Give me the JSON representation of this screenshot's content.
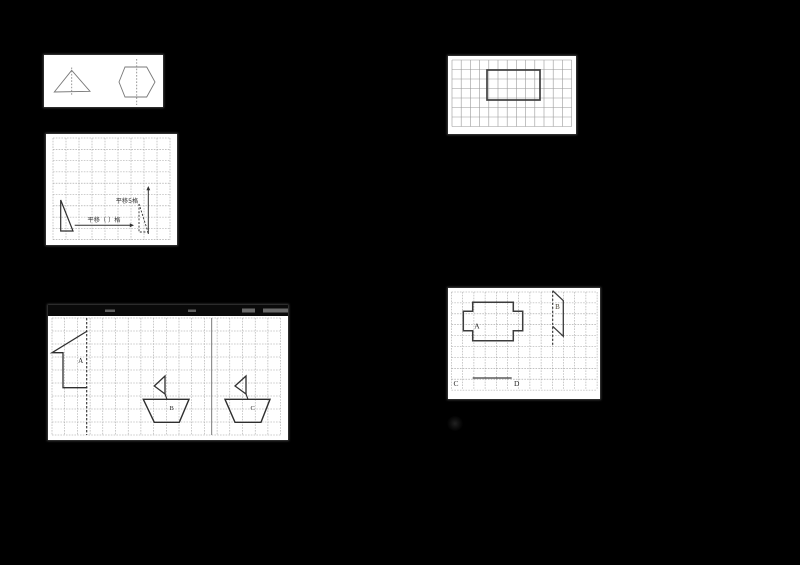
{
  "page": {
    "background": "#000000",
    "width": 800,
    "height": 565,
    "description": "Scanned elementary math worksheet figures (symmetry and translation) on black background"
  },
  "colors": {
    "panel_bg": "#ffffff",
    "grid_line": "#9e9e9e",
    "light_shape": "#787878",
    "bold_shape": "#333333",
    "label_text": "#2b2b2b"
  },
  "texts": {
    "translate_5_cells": "平移5格",
    "translate_blank_cells": "平移（ ）格",
    "label_a": "A",
    "label_b": "B",
    "label_c": "C",
    "label_d": "D"
  },
  "panels": [
    {
      "name": "symmetric-shapes-figure",
      "x": 44,
      "y": 55,
      "w": 119,
      "h": 52,
      "elements": [
        {
          "kind": "polygon",
          "name": "triangle-shape",
          "points": [
            [
              27.7,
              15.3
            ],
            [
              10.3,
              37
            ],
            [
              46,
              36.3
            ]
          ],
          "closed": true,
          "stroke": "#787878",
          "width": 0.9
        },
        {
          "kind": "line",
          "name": "triangle-symmetry-axis",
          "x1": 27.7,
          "y1": 12.5,
          "x2": 27.7,
          "y2": 41,
          "stroke": "#8a8a8a",
          "width": 0.9,
          "dash": "1.6,1.6"
        },
        {
          "kind": "polygon",
          "name": "hexagon-shape",
          "points": [
            [
              75,
              27
            ],
            [
              81,
              12
            ],
            [
              102.7,
              12
            ],
            [
              111,
              27
            ],
            [
              102.7,
              42
            ],
            [
              81,
              42
            ]
          ],
          "closed": true,
          "stroke": "#787878",
          "width": 0.9
        },
        {
          "kind": "line",
          "name": "hexagon-symmetry-axis",
          "x1": 92.7,
          "y1": 4,
          "x2": 92.7,
          "y2": 50,
          "stroke": "#8a8a8a",
          "width": 0.9,
          "dash": "1.6,1.6"
        }
      ]
    },
    {
      "name": "rectangle-grid-figure",
      "x": 448,
      "y": 56,
      "w": 128,
      "h": 78,
      "elements": [
        {
          "kind": "grid",
          "name": "grid-lines",
          "x": 4,
          "y": 4,
          "cols": 13,
          "rows": 7,
          "cw": 9.2,
          "ch": 9.5,
          "stroke": "#9a9a9a",
          "width": 0.6
        },
        {
          "kind": "rect",
          "name": "bold-rectangle",
          "x": 39,
          "y": 14,
          "w": 53,
          "h": 30,
          "stroke": "#3f3f3f",
          "width": 1.7,
          "fill": "none"
        }
      ]
    },
    {
      "name": "translation-triangles-figure",
      "x": 46,
      "y": 134,
      "w": 131,
      "h": 111,
      "elements": [
        {
          "kind": "grid",
          "name": "grid-lines",
          "x": 7,
          "y": 4,
          "cols": 9,
          "rows": 9,
          "cw": 13,
          "ch": 11.3,
          "stroke": "#9e9e9e",
          "width": 0.55,
          "dash": "1.6,1.2"
        },
        {
          "kind": "polygon",
          "name": "solid-triangle",
          "points": [
            [
              14.7,
              66
            ],
            [
              14.7,
              97
            ],
            [
              27,
              97
            ]
          ],
          "closed": true,
          "stroke": "#2f2f2f",
          "width": 1.2
        },
        {
          "kind": "polygon",
          "name": "dashed-triangle",
          "points": [
            [
              93,
              70
            ],
            [
              93,
              98
            ],
            [
              102,
              98
            ]
          ],
          "closed": true,
          "stroke": "#2f2f2f",
          "width": 0.9,
          "dash": "2,1.6"
        },
        {
          "kind": "arrow",
          "name": "horizontal-translation-arrow",
          "x1": 28.7,
          "y1": 91.3,
          "x2": 88,
          "y2": 91.3,
          "stroke": "#2f2f2f",
          "width": 1
        },
        {
          "kind": "arrow",
          "name": "vertical-translation-arrow",
          "x1": 102.3,
          "y1": 100,
          "x2": 102.3,
          "y2": 52,
          "stroke": "#2f2f2f",
          "width": 1
        },
        {
          "kind": "label",
          "name": "horizontal-translation-text",
          "x": 58,
          "y": 88,
          "text": "平移（ ）格",
          "size": 6.2,
          "fill": "#333333",
          "anchor": "middle",
          "font": "sans"
        },
        {
          "kind": "label",
          "name": "vertical-translation-text",
          "x": 81,
          "y": 69,
          "text": "平移5格",
          "size": 6.2,
          "fill": "#333333",
          "anchor": "middle",
          "font": "sans"
        }
      ]
    },
    {
      "name": "mirror-shapes-figure",
      "x": 448,
      "y": 288,
      "w": 152,
      "h": 111,
      "elements": [
        {
          "kind": "grid",
          "name": "grid-lines",
          "x": 3.5,
          "y": 4,
          "cols": 13,
          "rows": 9,
          "cw": 11.2,
          "ch": 10.9,
          "stroke": "#9e9e9e",
          "width": 0.55,
          "dash": "1.6,1.2"
        },
        {
          "kind": "polygon",
          "name": "cross-shape-a",
          "points": [
            [
              24.7,
              14.3
            ],
            [
              65.3,
              14.3
            ],
            [
              65.3,
              23.3
            ],
            [
              74.7,
              23.3
            ],
            [
              74.7,
              42.7
            ],
            [
              65.3,
              42.7
            ],
            [
              65.3,
              52.7
            ],
            [
              24.7,
              52.7
            ],
            [
              24.7,
              42.7
            ],
            [
              15.3,
              42.7
            ],
            [
              15.3,
              23.3
            ],
            [
              24.7,
              23.3
            ]
          ],
          "closed": true,
          "stroke": "#3c3c3c",
          "width": 1.5
        },
        {
          "kind": "label",
          "name": "shape-a-label",
          "x": 29,
          "y": 40.5,
          "text": "A",
          "size": 7.5,
          "fill": "#2b2b2b",
          "anchor": "middle",
          "font": "serif"
        },
        {
          "kind": "line",
          "name": "mirror-line-b",
          "x1": 104.7,
          "y1": 2.7,
          "x2": 104.7,
          "y2": 58.5,
          "stroke": "#2f2f2f",
          "width": 1.1,
          "dash": "2.2,1.8"
        },
        {
          "kind": "polygon",
          "name": "shape-b-parallelogram",
          "points": [
            [
              104.7,
              2.7
            ],
            [
              115.3,
              12.7
            ],
            [
              115.3,
              48.3
            ],
            [
              104.7,
              38.3
            ]
          ],
          "closed": false,
          "stroke": "#3c3c3c",
          "width": 1.3
        },
        {
          "kind": "label",
          "name": "shape-b-label",
          "x": 109.5,
          "y": 21,
          "text": "B",
          "size": 7,
          "fill": "#4a4536",
          "anchor": "middle",
          "font": "serif"
        },
        {
          "kind": "line",
          "name": "segment-cd",
          "x1": 24.7,
          "y1": 90,
          "x2": 63.7,
          "y2": 90,
          "stroke": "#3c3c3c",
          "width": 1.3
        },
        {
          "kind": "label",
          "name": "point-c-label",
          "x": 8,
          "y": 98,
          "text": "C",
          "size": 7.5,
          "fill": "#2b2b2b",
          "anchor": "middle",
          "font": "serif"
        },
        {
          "kind": "label",
          "name": "point-d-label",
          "x": 68.7,
          "y": 98,
          "text": "D",
          "size": 7.5,
          "fill": "#2b2b2b",
          "anchor": "middle",
          "font": "serif"
        }
      ]
    },
    {
      "name": "boats-grid-figure",
      "x": 48,
      "y": 305,
      "w": 240,
      "h": 135,
      "elements": [
        {
          "kind": "rect",
          "name": "cropped-text-strip",
          "x": 0,
          "y": 0,
          "w": 240,
          "h": 11,
          "fill": "#0a0a0a"
        },
        {
          "kind": "rect",
          "name": "cropped-text-mark",
          "x": 57,
          "y": 4.5,
          "w": 10,
          "h": 2.5,
          "fill": "#c8c8c8",
          "opacity": 0.45
        },
        {
          "kind": "rect",
          "name": "cropped-text-mark",
          "x": 140,
          "y": 4.5,
          "w": 8,
          "h": 2.5,
          "fill": "#c8c8c8",
          "opacity": 0.45
        },
        {
          "kind": "rect",
          "name": "cropped-text-mark",
          "x": 194,
          "y": 3.5,
          "w": 13,
          "h": 4,
          "fill": "#c8c8c8",
          "opacity": 0.5
        },
        {
          "kind": "rect",
          "name": "cropped-text-mark",
          "x": 215,
          "y": 3.5,
          "w": 26,
          "h": 4,
          "fill": "#c8c8c8",
          "opacity": 0.5
        },
        {
          "kind": "grid",
          "name": "grid-lines",
          "x": 4,
          "y": 13,
          "cols": 18,
          "rows": 9,
          "cw": 12.7,
          "ch": 13,
          "stroke": "#9e9e9e",
          "width": 0.55,
          "dash": "1.6,1.2"
        },
        {
          "kind": "line",
          "name": "mirror-line-a",
          "x1": 38.7,
          "y1": 13,
          "x2": 38.7,
          "y2": 130,
          "stroke": "#2f2f2f",
          "width": 1.1,
          "dash": "2.4,1.6"
        },
        {
          "kind": "line",
          "name": "dark-grid-line",
          "x1": 163.7,
          "y1": 13,
          "x2": 163.7,
          "y2": 130,
          "stroke": "#6a6a6a",
          "width": 0.9
        },
        {
          "kind": "polygon",
          "name": "flag-shape-a",
          "points": [
            [
              39.3,
              26
            ],
            [
              4,
              47.7
            ],
            [
              15,
              47.7
            ],
            [
              15,
              82.7
            ],
            [
              39.3,
              82.7
            ]
          ],
          "closed": false,
          "stroke": "#2f2f2f",
          "width": 1.3
        },
        {
          "kind": "label",
          "name": "shape-a-label",
          "x": 32.7,
          "y": 58,
          "text": "A",
          "size": 7,
          "fill": "#2b2b2b",
          "anchor": "middle",
          "font": "serif"
        },
        {
          "kind": "polygon",
          "name": "boat-b-sail",
          "points": [
            [
              117,
              71
            ],
            [
              117,
              89
            ],
            [
              106.3,
              81
            ]
          ],
          "closed": true,
          "stroke": "#2f2f2f",
          "width": 1.3
        },
        {
          "kind": "line",
          "name": "boat-b-mast",
          "x1": 117,
          "y1": 89,
          "x2": 119,
          "y2": 94.3,
          "stroke": "#2f2f2f",
          "width": 1.1
        },
        {
          "kind": "polygon",
          "name": "boat-b-hull",
          "points": [
            [
              95.3,
              94.3
            ],
            [
              141,
              94.3
            ],
            [
              131.3,
              117.3
            ],
            [
              106.3,
              117.3
            ]
          ],
          "closed": true,
          "stroke": "#2f2f2f",
          "width": 1.4
        },
        {
          "kind": "label",
          "name": "boat-b-label",
          "x": 123.7,
          "y": 105,
          "text": "B",
          "size": 6.5,
          "fill": "#2b2b2b",
          "anchor": "middle",
          "font": "serif"
        },
        {
          "kind": "polygon",
          "name": "boat-c-sail",
          "points": [
            [
              198,
              71
            ],
            [
              198,
              89
            ],
            [
              187,
              81
            ]
          ],
          "closed": true,
          "stroke": "#2f2f2f",
          "width": 1.3
        },
        {
          "kind": "line",
          "name": "boat-c-mast",
          "x1": 198,
          "y1": 89,
          "x2": 200,
          "y2": 94.3,
          "stroke": "#2f2f2f",
          "width": 1.1
        },
        {
          "kind": "polygon",
          "name": "boat-c-hull",
          "points": [
            [
              177,
              94.3
            ],
            [
              222,
              94.3
            ],
            [
              213,
              117.3
            ],
            [
              187,
              117.3
            ]
          ],
          "closed": true,
          "stroke": "#2f2f2f",
          "width": 1.4
        },
        {
          "kind": "label",
          "name": "boat-c-label",
          "x": 204.7,
          "y": 105,
          "text": "C",
          "size": 6.5,
          "fill": "#2b2b2b",
          "anchor": "middle",
          "font": "serif"
        }
      ]
    }
  ],
  "artifacts": [
    {
      "name": "faint-smudge",
      "x": 447,
      "y": 416,
      "w": 16,
      "h": 15
    }
  ]
}
